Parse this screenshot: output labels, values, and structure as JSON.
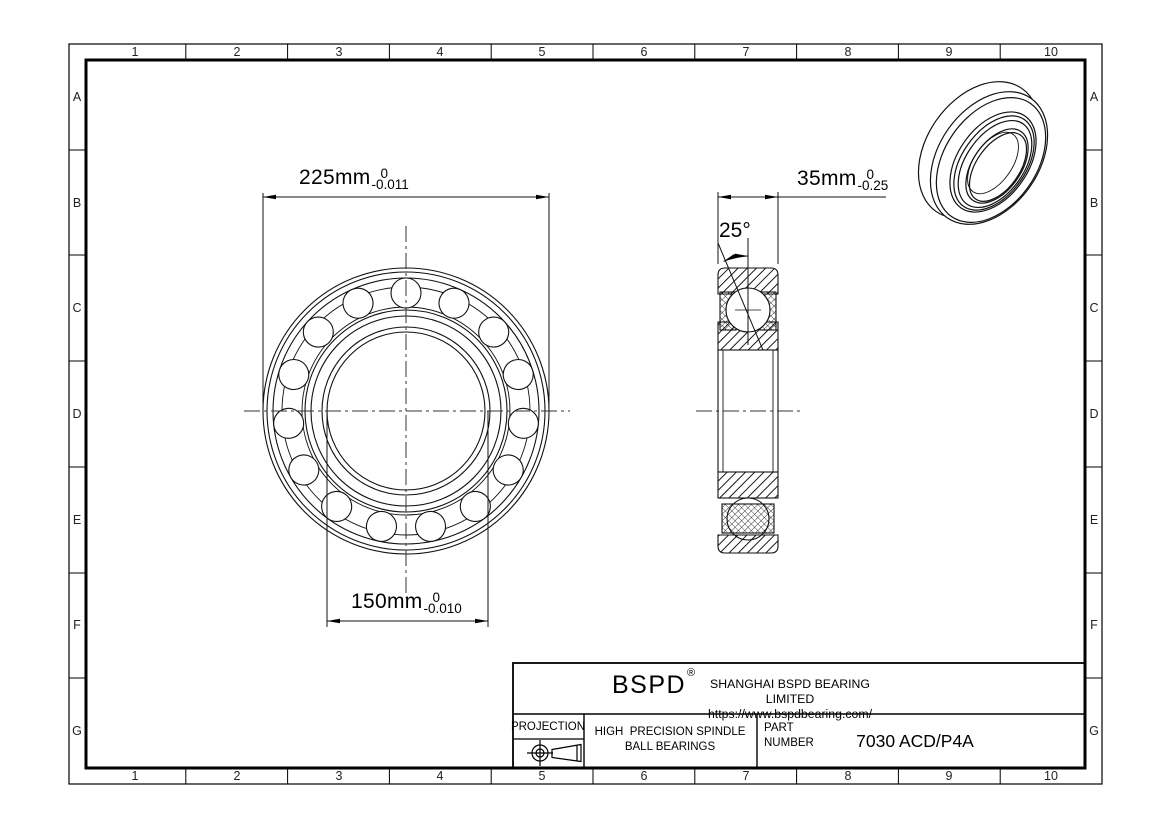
{
  "style": {
    "bg": "#ffffff",
    "line_color": "#000000"
  },
  "grid": {
    "cols": [
      "1",
      "2",
      "3",
      "4",
      "5",
      "6",
      "7",
      "8",
      "9",
      "10"
    ],
    "rows": [
      "A",
      "B",
      "C",
      "D",
      "E",
      "F",
      "G"
    ]
  },
  "dimensions": {
    "outer_diameter": {
      "value": "225mm",
      "tol_upper": "0",
      "tol_lower": "-0.011"
    },
    "bore_diameter": {
      "value": "150mm",
      "tol_upper": "0",
      "tol_lower": "-0.010"
    },
    "width": {
      "value": "35mm",
      "tol_upper": "0",
      "tol_lower": "-0.25"
    },
    "contact_angle": {
      "label": "25°"
    }
  },
  "title_block": {
    "logo": "BSPD",
    "logo_mark": "®",
    "company": "SHANGHAI BSPD BEARING LIMITED",
    "website": "https://www.bspdbearing.com/",
    "projection_label": "PROJECTION",
    "product_line1": "HIGH  PRECISION SPINDLE",
    "product_line2": "BALL BEARINGS",
    "part_label_line1": "PART",
    "part_label_line2": "NUMBER",
    "part_number": "7030 ACD/P4A"
  }
}
